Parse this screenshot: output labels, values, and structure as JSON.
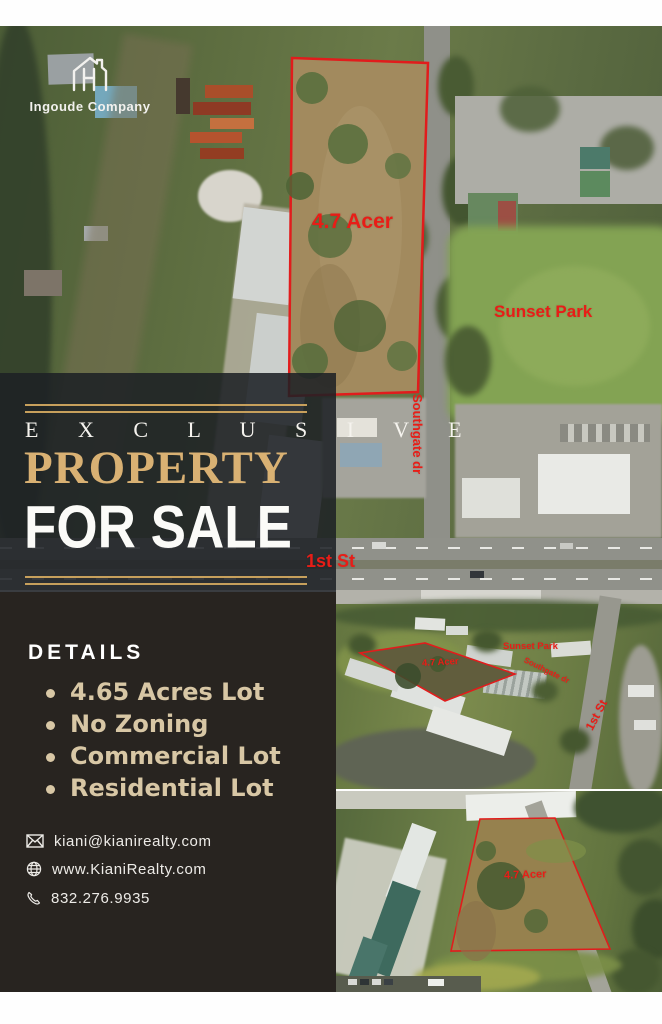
{
  "logo": {
    "company": "Ingoude Company",
    "icon": "house-logo-icon"
  },
  "hero": {
    "eyebrow": "E X C L U S I V E",
    "title": "PROPERTY",
    "subtitle": "FOR SALE"
  },
  "details": {
    "heading": "DETAILS",
    "items": [
      "4.65 Acres Lot",
      "No Zoning",
      "Commercial Lot",
      "Residential Lot"
    ]
  },
  "contact": {
    "email": "kiani@kianirealty.com",
    "website": "www.KianiRealty.com",
    "phone": "832.276.9935"
  },
  "map_labels": {
    "main": {
      "acreage": "4.7 Acer",
      "park": "Sunset Park",
      "street_vertical": "Southgate dr",
      "street": "1st St"
    },
    "middle": {
      "acreage": "4.7 Acer",
      "park": "Sunset Park",
      "street_diagonal": "Southgate dr",
      "street": "1st St"
    },
    "bottom": {
      "acreage": "4.7 Acer"
    }
  },
  "colors": {
    "accent_gold": "#c7a05c",
    "gold_text": "#d9b173",
    "beige_text": "#d8c7a5",
    "label_red": "#e81d17",
    "panel_dark": "#282420",
    "panel_overlay": "rgba(29,32,37,0.87)"
  }
}
